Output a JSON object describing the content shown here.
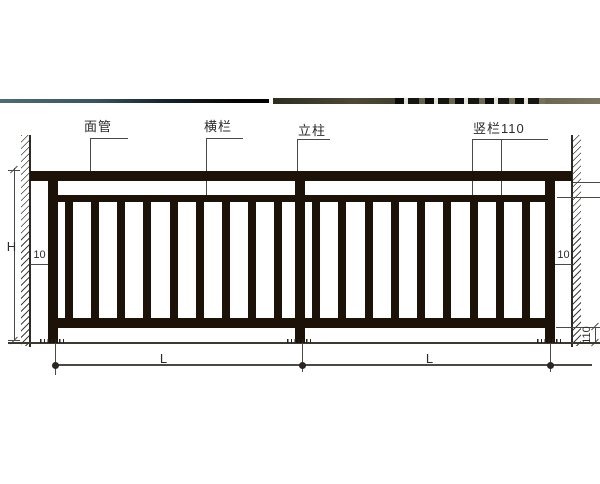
{
  "drawing": {
    "title": "railing elevation diagram",
    "callouts": {
      "top_tube": "面管",
      "cross_rail": "横栏",
      "post": "立柱",
      "vertical_bars": "竖栏110"
    },
    "dimensions": {
      "overall_height": "H",
      "left_wall_gap": "10",
      "right_wall_gap": "10",
      "bottom_clearance": "110",
      "left_span": "L",
      "right_span": "L"
    },
    "structure": {
      "panels": 2,
      "bars_per_panel": 9,
      "posts": 3
    },
    "colors": {
      "frame": "#1d1208",
      "line": "#4a4a45",
      "text": "#2b2b2b",
      "photo_strip_left": "#3a545e",
      "photo_strip_right": "#6f6c55"
    }
  }
}
